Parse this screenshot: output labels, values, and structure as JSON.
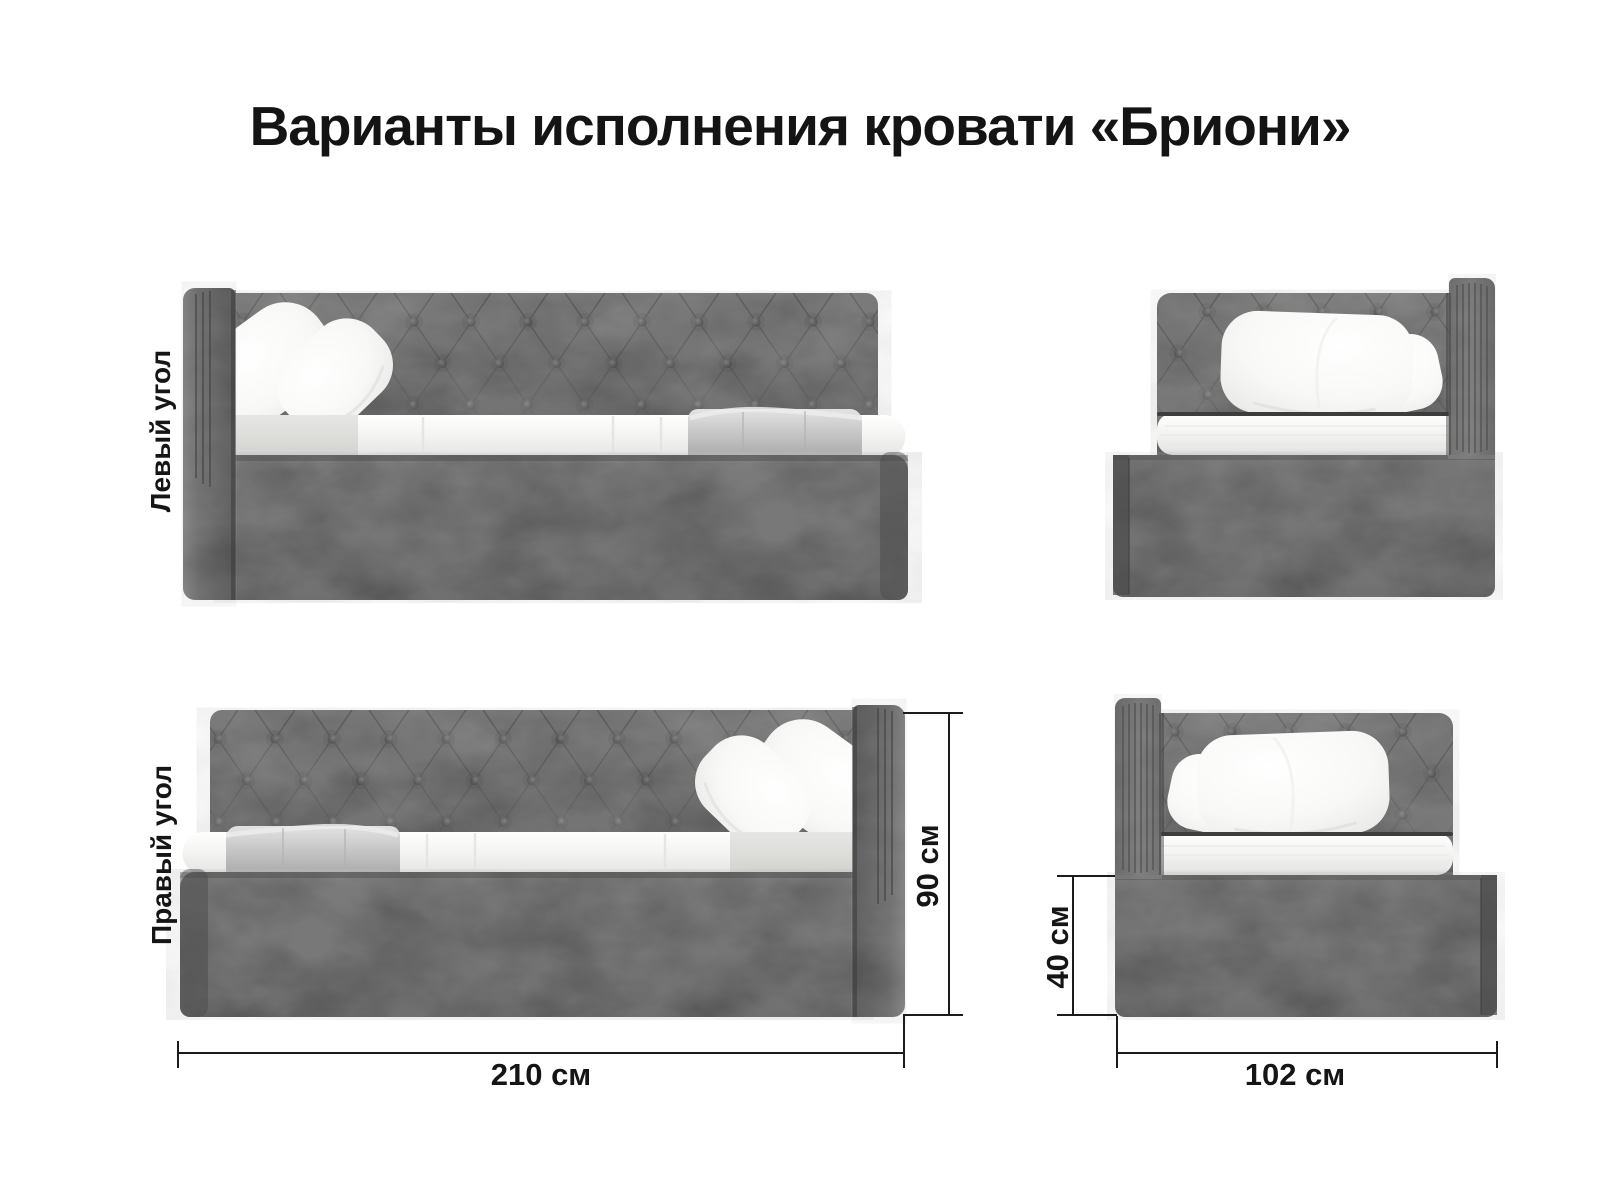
{
  "title": "Варианты исполнения кровати «Бриони»",
  "product_name": "Бриони",
  "views": {
    "left_corner_label": "Левый угол",
    "right_corner_label": "Правый угол"
  },
  "dimensions": {
    "length_label": "210 см",
    "height_label": "90 см",
    "base_height_label": "40 см",
    "width_label": "102 см"
  },
  "colors": {
    "fabric": "#5b5b5b",
    "fabric_dark": "#4a4a4a",
    "mattress": "#f3f3f1",
    "pillow": "#ffffff",
    "plaid": "#c9c9c9",
    "dimension_lines": "#1b1b1b",
    "text": "#151515",
    "background": "#ffffff"
  }
}
